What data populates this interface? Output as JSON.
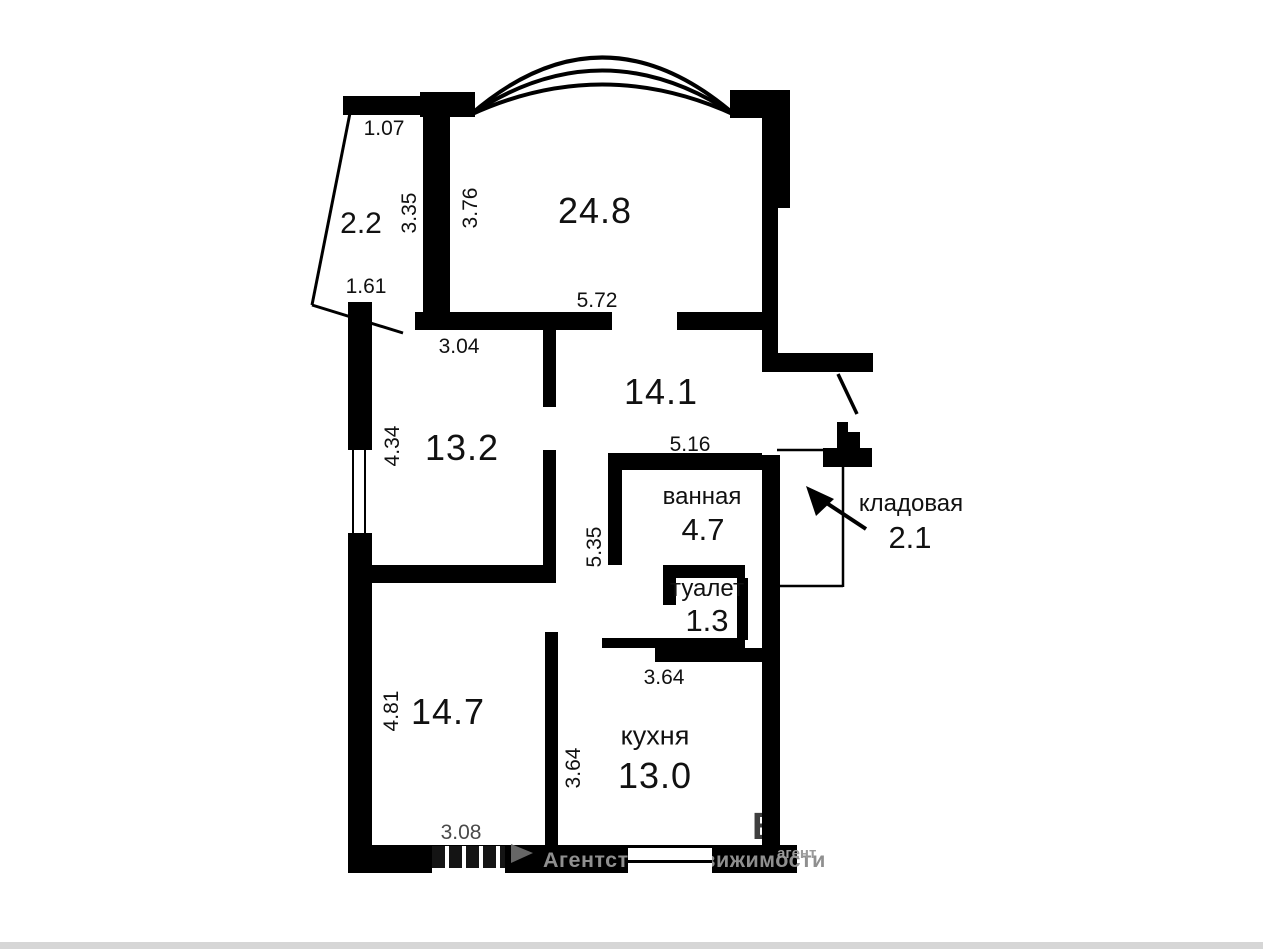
{
  "colors": {
    "wall": "#000000",
    "watermark_gray": "#8f8f8f"
  },
  "plan": {
    "rooms": {
      "balcony": {
        "area": "2.2"
      },
      "living": {
        "area": "24.8"
      },
      "bedroom1": {
        "area": "13.2"
      },
      "hall": {
        "area": "14.1"
      },
      "bathroom": {
        "name": "ванная",
        "area": "4.7"
      },
      "toilet": {
        "name": "туалет",
        "area": "1.3"
      },
      "storage": {
        "name": "кладовая",
        "area": "2.1"
      },
      "bedroom2": {
        "area": "14.7"
      },
      "kitchen": {
        "name": "кухня",
        "area": "13.0"
      }
    },
    "dims": {
      "d107": "1.07",
      "d161": "1.61",
      "d335": "3.35",
      "d376": "3.76",
      "d572": "5.72",
      "d304": "3.04",
      "d434": "4.34",
      "d516": "5.16",
      "d535": "5.35",
      "d364a": "3.64",
      "d364b": "3.64",
      "d481": "4.81",
      "d308": "3.08"
    }
  },
  "watermark": {
    "agency": "Агентство недвижимости",
    "fragment": "агент",
    "letter": "В"
  }
}
